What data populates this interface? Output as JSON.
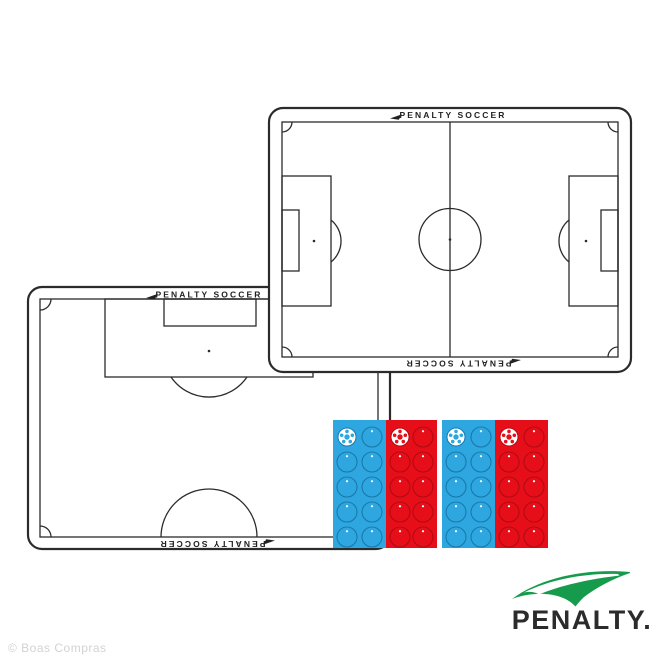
{
  "watermark": {
    "text": "© Boas Compras"
  },
  "brand": {
    "logo_text": "PENALTY.",
    "logo_green": "#169B4C",
    "logo_text_color": "#2b2b2b"
  },
  "boards": {
    "line_color": "#2b2b2b",
    "full_field": {
      "label_top": "PENALTY SOCCER",
      "label_bottom": "PENALTY SOCCER"
    },
    "half_field": {
      "label_top": "PENALTY SOCCER",
      "label_bottom": "PENALTY SOCCER"
    }
  },
  "magnet_trays": {
    "team_colors": {
      "blue": "#2EA7E0",
      "blue_outline": "#1879AC",
      "red": "#E60E19",
      "red_outline": "#B40A12"
    },
    "y": 420,
    "height": 128,
    "rows_per_section": 5,
    "columns_per_section": 2,
    "magnets_per_section": 10,
    "ball_magnets_per_section": 1,
    "sections": [
      {
        "color": "blue",
        "x": 333,
        "width": 53
      },
      {
        "color": "red",
        "x": 386,
        "width": 51
      },
      {
        "color": "blue",
        "x": 442,
        "width": 53
      },
      {
        "color": "red",
        "x": 495,
        "width": 53
      }
    ]
  }
}
